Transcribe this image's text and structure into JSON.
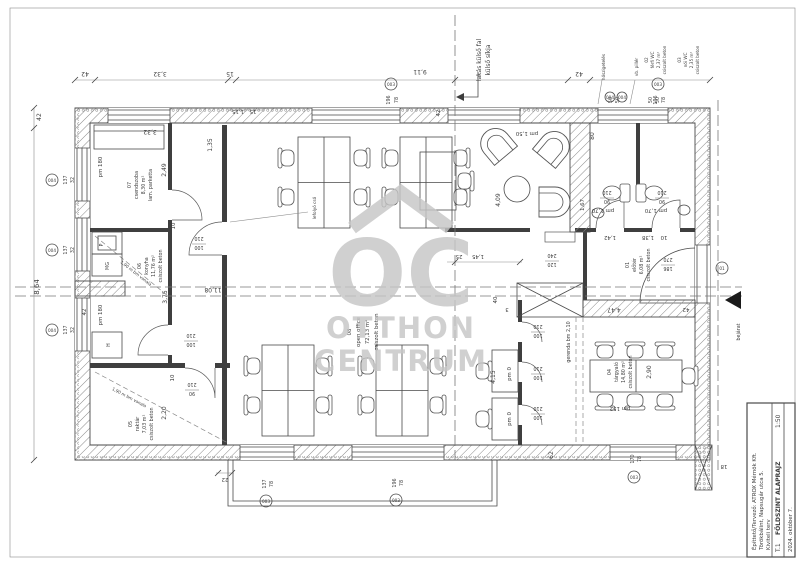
{
  "title_block": {
    "owner": "Építtető/Tervező: ATROX Mérnök Kft.",
    "address": "Törökbálint, Napsugár utca 5.",
    "phase": "Kiviteli terv",
    "sheet_no": "T.1",
    "drawing_title": "FÖLDSZINT ALAPRAJZ",
    "scale": "1:50",
    "date": "2024. október 7."
  },
  "watermark": {
    "oc": "OC",
    "otthon": "OTTHON",
    "centrum": "CENTRUM"
  },
  "rooms": {
    "r01": {
      "num": "01",
      "name": "előtér",
      "area": "6,08 m²",
      "floor": "csiszolt beton"
    },
    "r02": {
      "num": "02",
      "name": "férfi WC",
      "area": "2,37 m²",
      "floor": "csiszolt beton"
    },
    "r03": {
      "num": "03",
      "name": "női WC",
      "area": "2,35 m²",
      "floor": "csiszolt beton"
    },
    "r04": {
      "num": "04",
      "name": "tárgyaló",
      "area": "14,80 m²",
      "floor": "csiszolt beton"
    },
    "r05": {
      "num": "05",
      "name": "raktár",
      "area": "7,03 m²",
      "floor": "csiszolt beton"
    },
    "r06": {
      "num": "06",
      "name": "konyha",
      "area": "11,76 m²",
      "floor": "csiszolt beton"
    },
    "r07": {
      "num": "07",
      "name": "csendszoba",
      "area": "8,30 m²",
      "floor": "lam. parketta"
    },
    "r08": {
      "num": "08",
      "name": "open office",
      "area": "72,13 m²",
      "floor": "csiszolt beton"
    }
  },
  "dims": {
    "v42": "42",
    "v332": "3,32",
    "v15": "15",
    "v911": "9,11",
    "v135": "1,35",
    "v115": "1,15",
    "v249": "2,49",
    "v10": "10",
    "v375": "3,75",
    "v864": "8,64",
    "v220": "2,20",
    "v1108": "11,08",
    "v409": "4,09",
    "v145": "1,45",
    "v25": "25",
    "v40": "40",
    "v3": "3",
    "v415": "4,15",
    "v290": "2,90",
    "v447": "4,47",
    "v142": "1,42",
    "v138": "1,38",
    "v167": "1,67",
    "v80": "80",
    "v50": "50",
    "v62": "62",
    "v22": "22",
    "v18": "18"
  },
  "openings": {
    "w90": "90",
    "w100": "100",
    "w120": "120",
    "w186": "186",
    "w137": "137",
    "w196": "196",
    "w170": "170",
    "h210": "210",
    "h240": "240",
    "h270": "270",
    "s32": "32",
    "s78": "78"
  },
  "pm": {
    "p180": "pm 180",
    "p150": "pm 1,50",
    "p170": "pm 1,70",
    "p152": "pm 152",
    "p0": "pm 0"
  },
  "tags": {
    "t003": "003",
    "t004": "004",
    "t01": "01"
  },
  "notes": {
    "wall1": "lakás külső fal",
    "wall2": "külső síkja",
    "entrance": "bejárat",
    "beam": "gerenda bm 2,10",
    "drain": "lefolyó cső",
    "headroom": "1,90 m bm vonala",
    "note1": "hőszigetelés",
    "note2": "vb. pillér"
  },
  "appliances": {
    "fridge": "H",
    "dishwasher": "MG",
    "sink": "P"
  }
}
